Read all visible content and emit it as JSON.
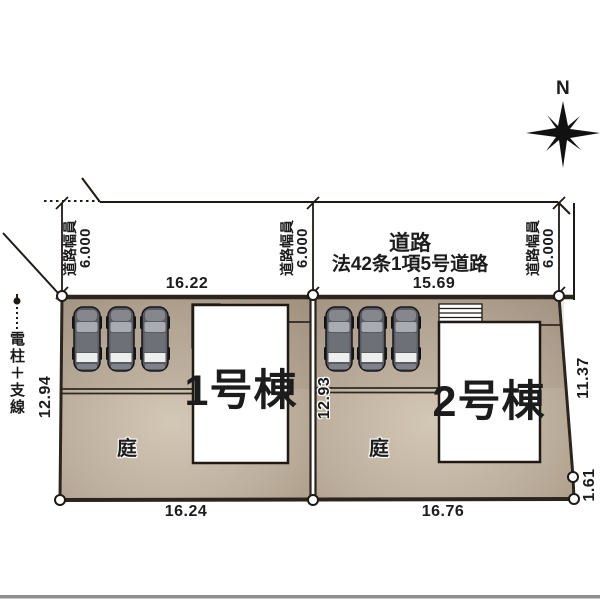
{
  "compass": {
    "north_label": "N"
  },
  "road": {
    "name": "道路",
    "designation": "法42条1項5号道路",
    "width_label": "道路幅員",
    "width_value": "6.000"
  },
  "utility": {
    "label": "電柱＋支線"
  },
  "plots": [
    {
      "building": "1号棟",
      "garden": "庭",
      "frontage_top": "16.22",
      "frontage_bottom": "16.24",
      "depth_left": "12.94"
    },
    {
      "building": "2号棟",
      "garden": "庭",
      "frontage_top": "15.69",
      "frontage_bottom": "16.76",
      "depth_left": "12.93",
      "depth_right": "11.37",
      "edge_short": "1.61"
    }
  ],
  "colors": {
    "line": "#2b251d",
    "lot_fill": "#b7a896",
    "lot_fill_light": "#d3c7b5",
    "building_fill": "#ffffff",
    "road_fill": "#ffffff",
    "car_body": "#5a5b60",
    "bottom_bar": "#8e8e8e",
    "halo": "#ffffff"
  }
}
